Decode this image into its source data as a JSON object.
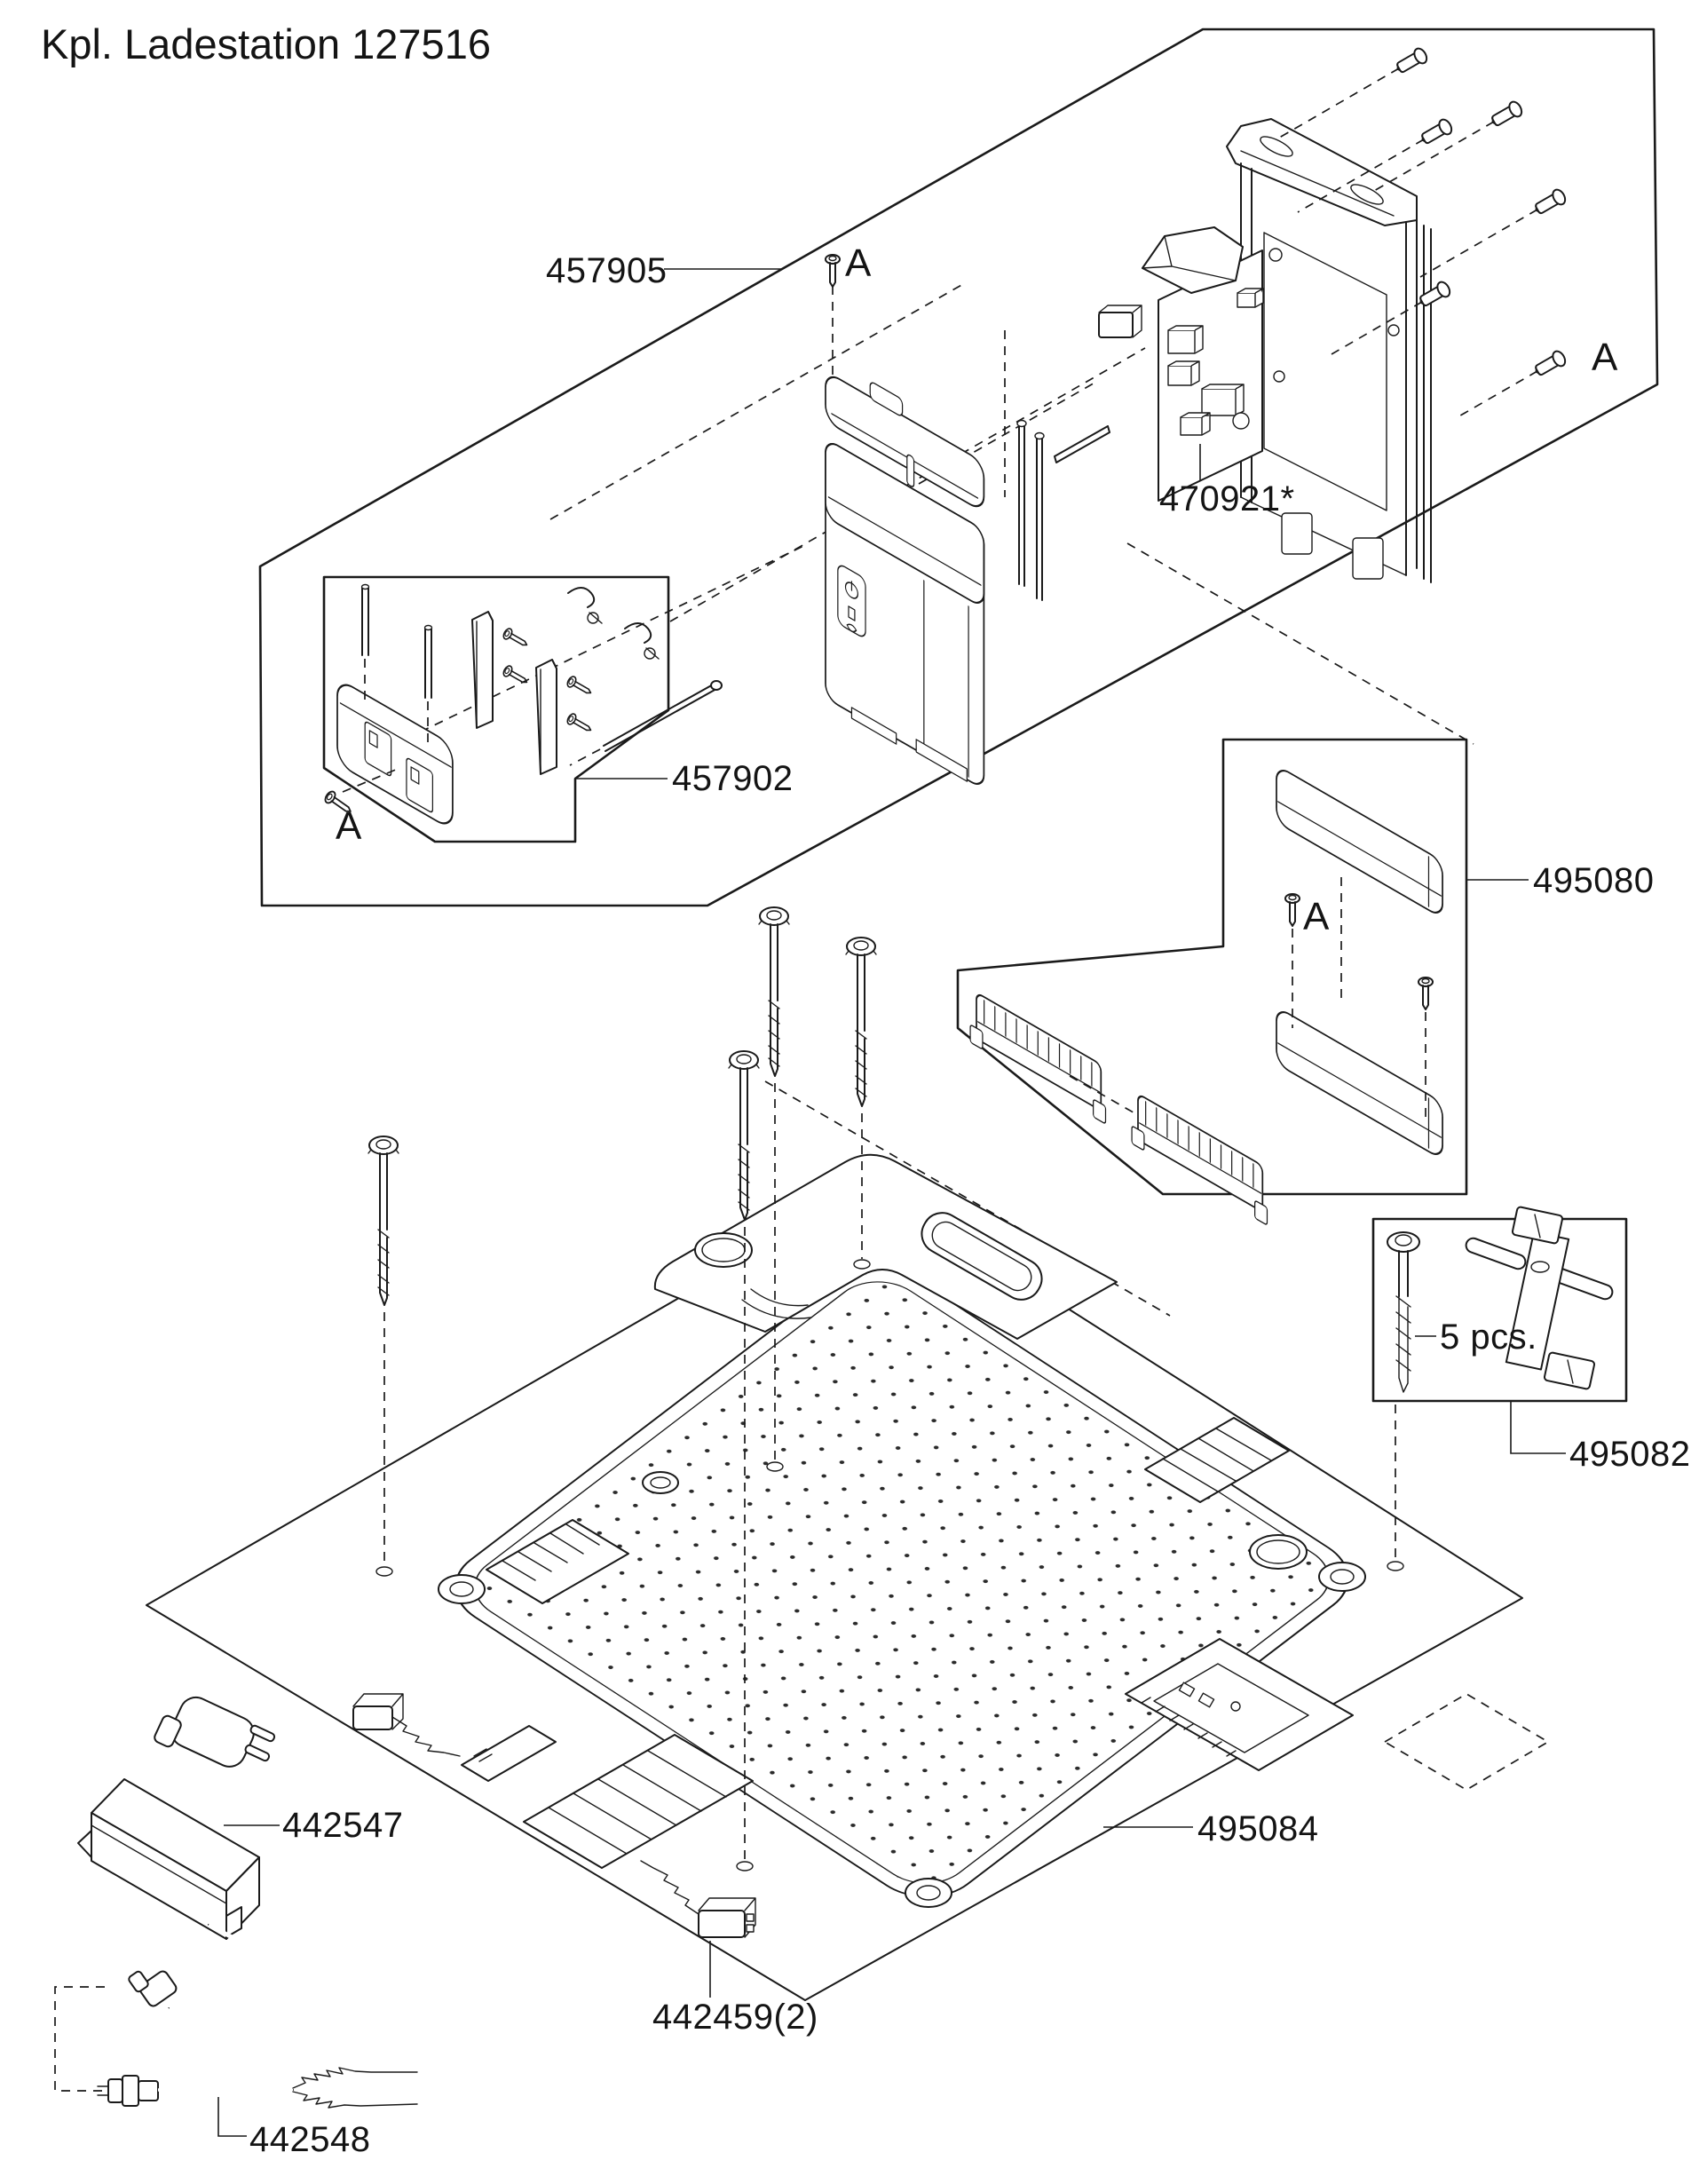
{
  "diagram": {
    "title": "Kpl. Ladestation 127516",
    "marker_screw": "A",
    "quantity_note": "5 pcs.",
    "parts": {
      "p457905": "457905",
      "p470921": "470921*",
      "p457902": "457902",
      "p495080": "495080",
      "p495082": "495082",
      "p442547": "442547",
      "p495084": "495084",
      "p442459": "442459(2)",
      "p442548": "442548"
    },
    "colors": {
      "ink": "#1a1a1a",
      "paper": "#ffffff"
    }
  }
}
